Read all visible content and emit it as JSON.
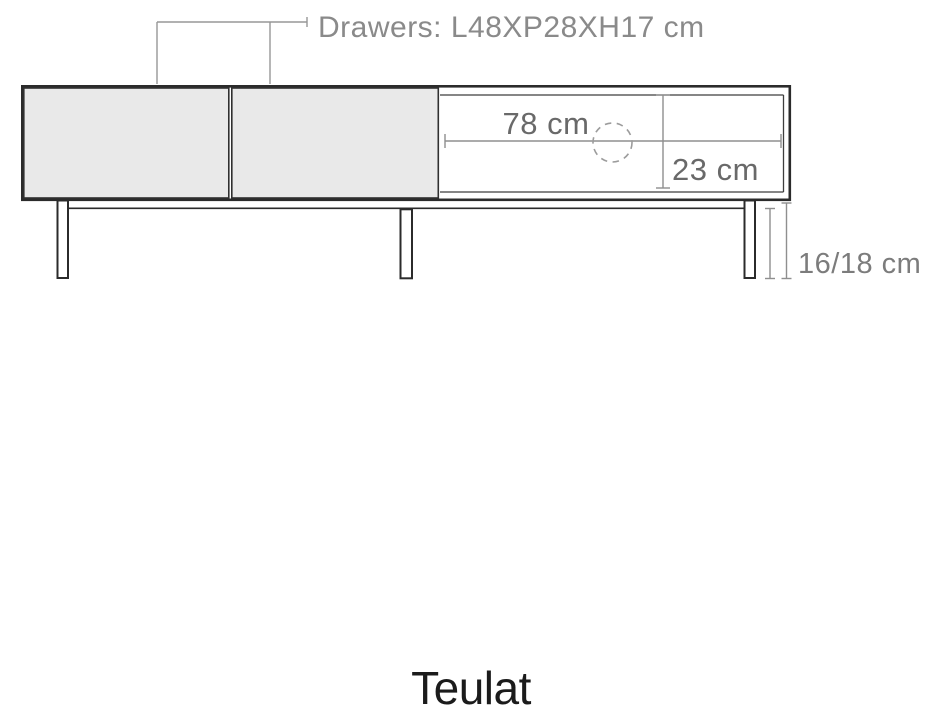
{
  "diagram": {
    "labels": {
      "drawers": "Drawers: L48XP28XH17 cm",
      "shelf_width": "78 cm",
      "shelf_height": "23 cm",
      "leg_height": "16/18 cm"
    },
    "dimensions": {
      "drawer_length_cm": 48,
      "drawer_depth_cm": 28,
      "drawer_height_cm": 17,
      "shelf_width_cm": 78,
      "shelf_height_cm": 23,
      "leg_height_cm": "16/18"
    }
  },
  "brand": "Teulat",
  "colors": {
    "background": "#ffffff",
    "drawer_fill": "#e9e9e9",
    "outline": "#2b2b2b",
    "dimension_line": "#8f8f8f",
    "annotation_text": "#8a8a8a",
    "dimension_text": "#696969",
    "brand_text": "#1b1b1b"
  }
}
